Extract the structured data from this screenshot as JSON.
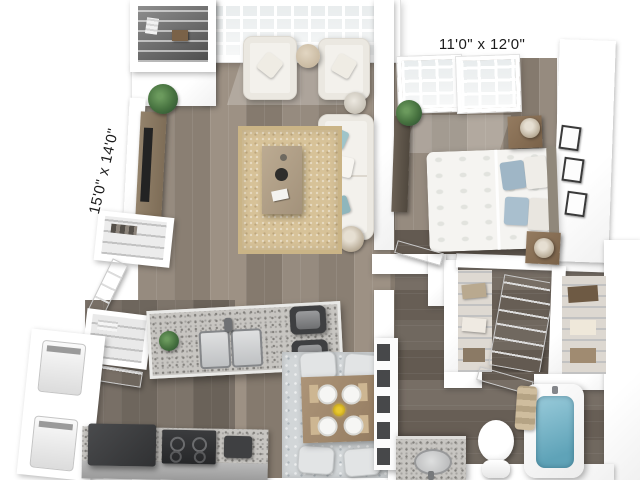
{
  "image": {
    "kind": "3D dollhouse floor-plan rendering of a one-bedroom apartment",
    "background": "#ffffff"
  },
  "labels": {
    "living_room_dimensions": "15'0\" x 14'0\"",
    "bedroom_dimensions": "11'0\" x 12'0\""
  },
  "rooms": [
    {
      "name": "living-room",
      "dimensions": "15'0\" x 14'0\"",
      "furniture": [
        "floor-to-ceiling-windows",
        "armchair",
        "armchair",
        "round-side-table",
        "sofa-with-teal-pillows",
        "jute-rug",
        "coffee-table",
        "tv-console",
        "tv",
        "potted-plant",
        "floor-lamp",
        "decor-vase",
        "entry-closet-wire-shelves"
      ]
    },
    {
      "name": "bedroom",
      "dimensions": "11'0\" x 12'0\"",
      "furniture": [
        "windows",
        "queen-bed-white-duvet-blue-pillows",
        "headboard",
        "nightstand-with-lamp",
        "nightstand-with-lamp",
        "dresser",
        "potted-plant",
        "three-wall-art-frames"
      ]
    },
    {
      "name": "kitchen",
      "furniture": [
        "granite-island-double-sink",
        "faucet",
        "two-bar-stools",
        "small-plant",
        "refrigerator",
        "range-with-burners",
        "counter",
        "pantry-closet",
        "pantry-closet"
      ]
    },
    {
      "name": "dining-area",
      "furniture": [
        "square-wood-table",
        "four-chairs",
        "four-place-settings",
        "yellow-flower-centerpiece",
        "area-rug",
        "tall-shelf-unit"
      ]
    },
    {
      "name": "laundry-closet",
      "furniture": [
        "washer",
        "dryer",
        "bifold-doors"
      ]
    },
    {
      "name": "walk-in-closet",
      "furniture": [
        "wire-shelving",
        "hanging-clothes",
        "panel-doors"
      ]
    },
    {
      "name": "bathroom",
      "furniture": [
        "granite-vanity-sink",
        "toilet",
        "bathtub-with-water",
        "rolled-towels",
        "door"
      ]
    }
  ],
  "palette": {
    "walls": "#ffffff",
    "wood_floor": "#8f8478",
    "wood_floor_dark": "#736a5f",
    "living_rug": "#d7c298",
    "dining_rug": "#d2d6d8",
    "upholstery": "#f3f1ec",
    "accent_pillows": "#9fc4c9",
    "bed_pillows_blue": "#9fb6c6",
    "granite": "#c7c5c1",
    "appliances_dark": "#3a3b3d",
    "tub_water": "#6fb0c2",
    "wood_furniture": "#8a735c",
    "label_text": "#1b1b1b"
  }
}
